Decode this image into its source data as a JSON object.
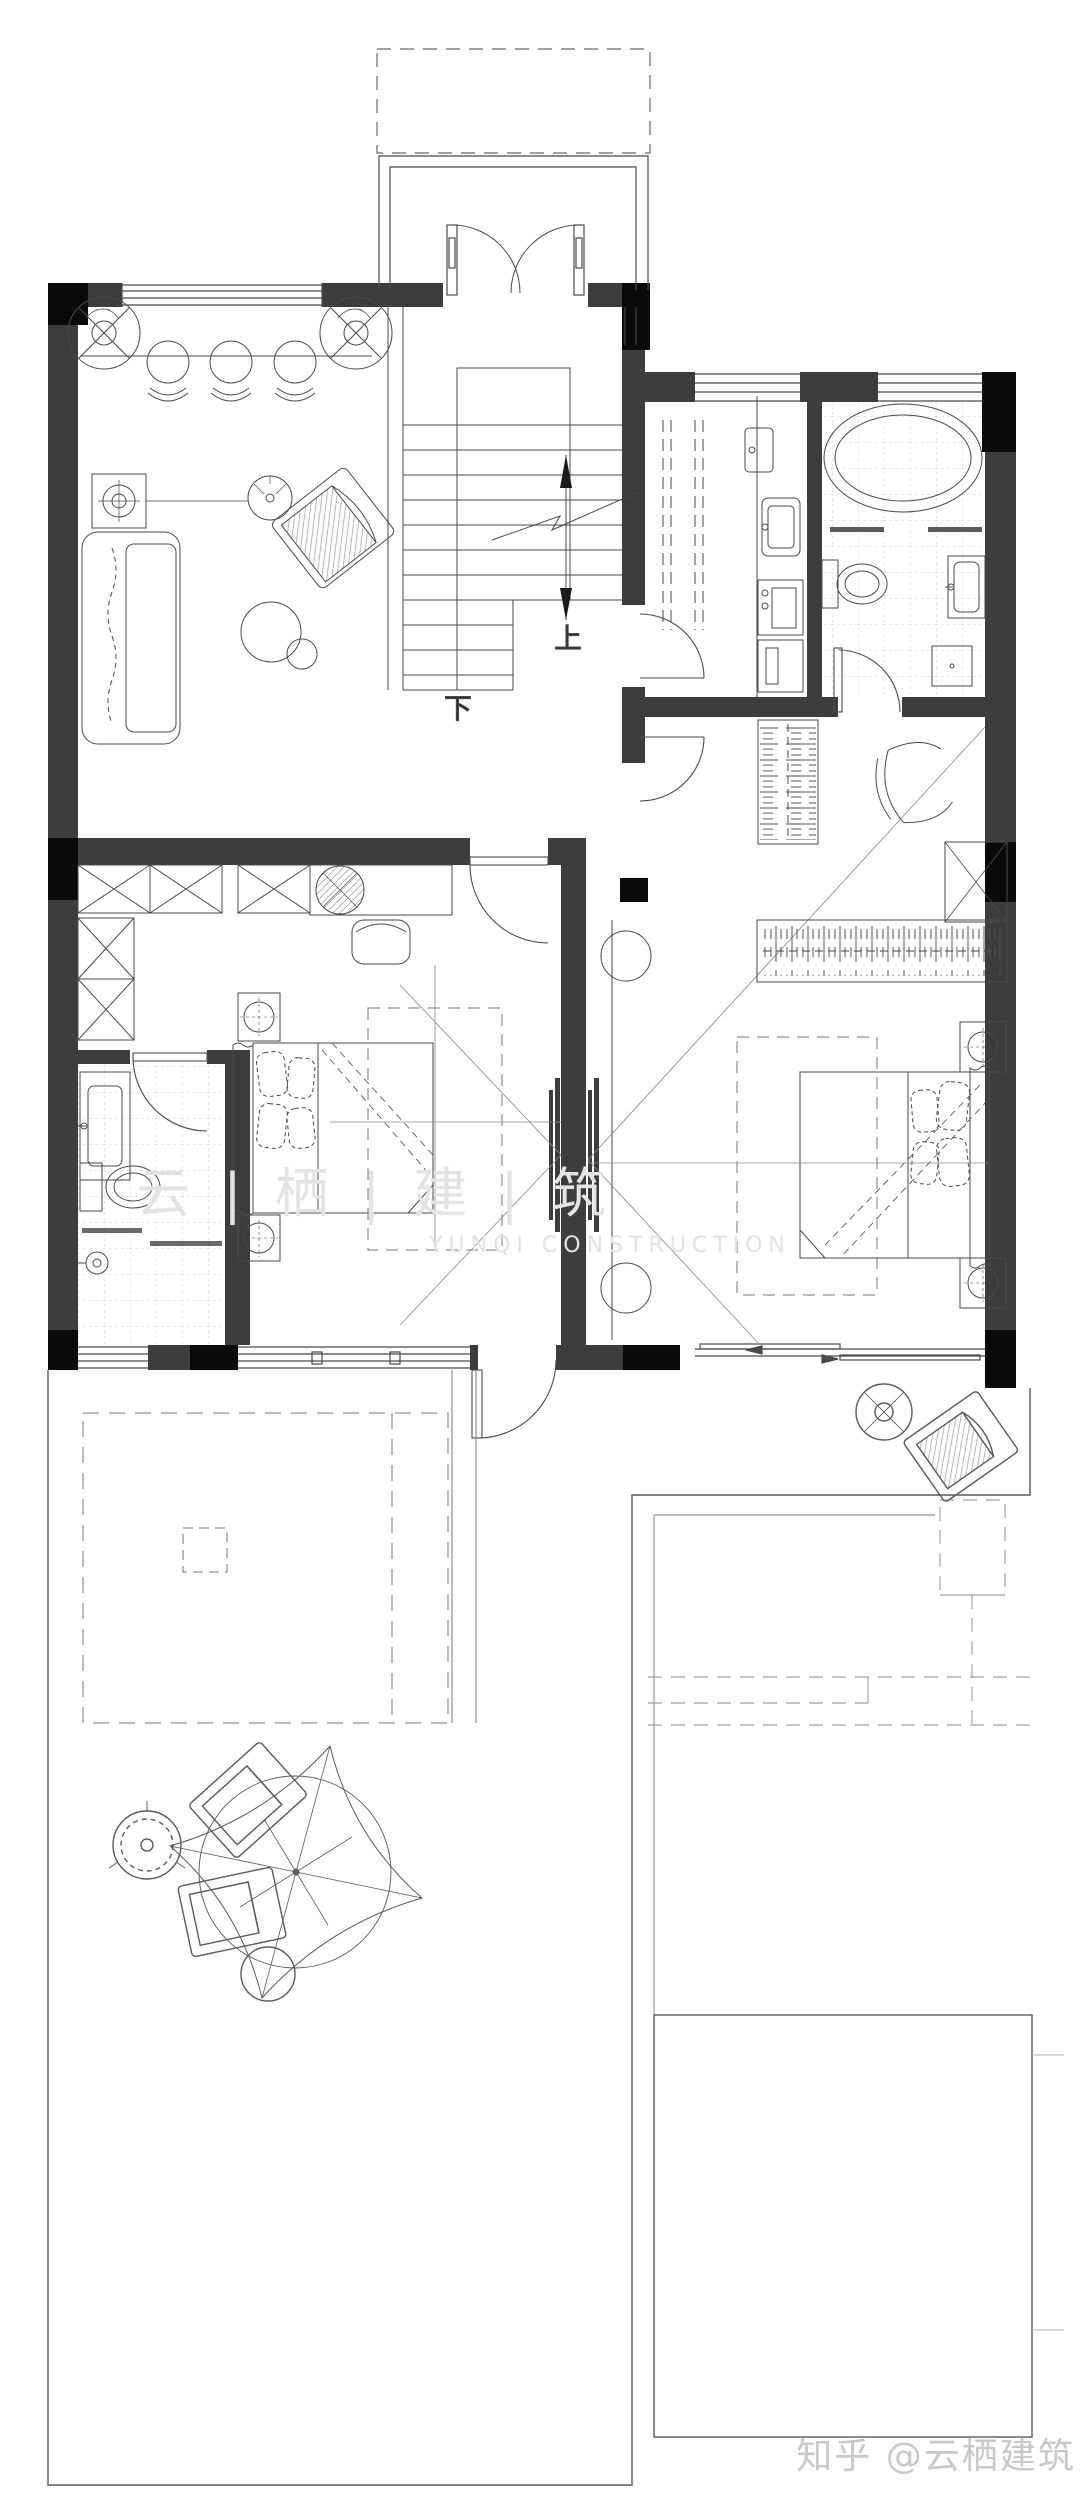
{
  "plan": {
    "stair": {
      "up_label": "上",
      "down_label": "下"
    },
    "watermark": {
      "center_cn": "云 | 栖 | 建 | 筑",
      "center_en": "YUNQI CONSTRUCTION",
      "bottom_right": "知乎 @云栖建筑"
    },
    "colors": {
      "background": "#ffffff",
      "wall": "#3d3d3d",
      "wall_dark": "#0a0a0a",
      "line": "#4a4a4a",
      "line_light": "#8a8a8a",
      "tile": "#c9c9c9",
      "watermark": "#c9c9c9",
      "watermark_faint": "#e4e4e4"
    }
  }
}
